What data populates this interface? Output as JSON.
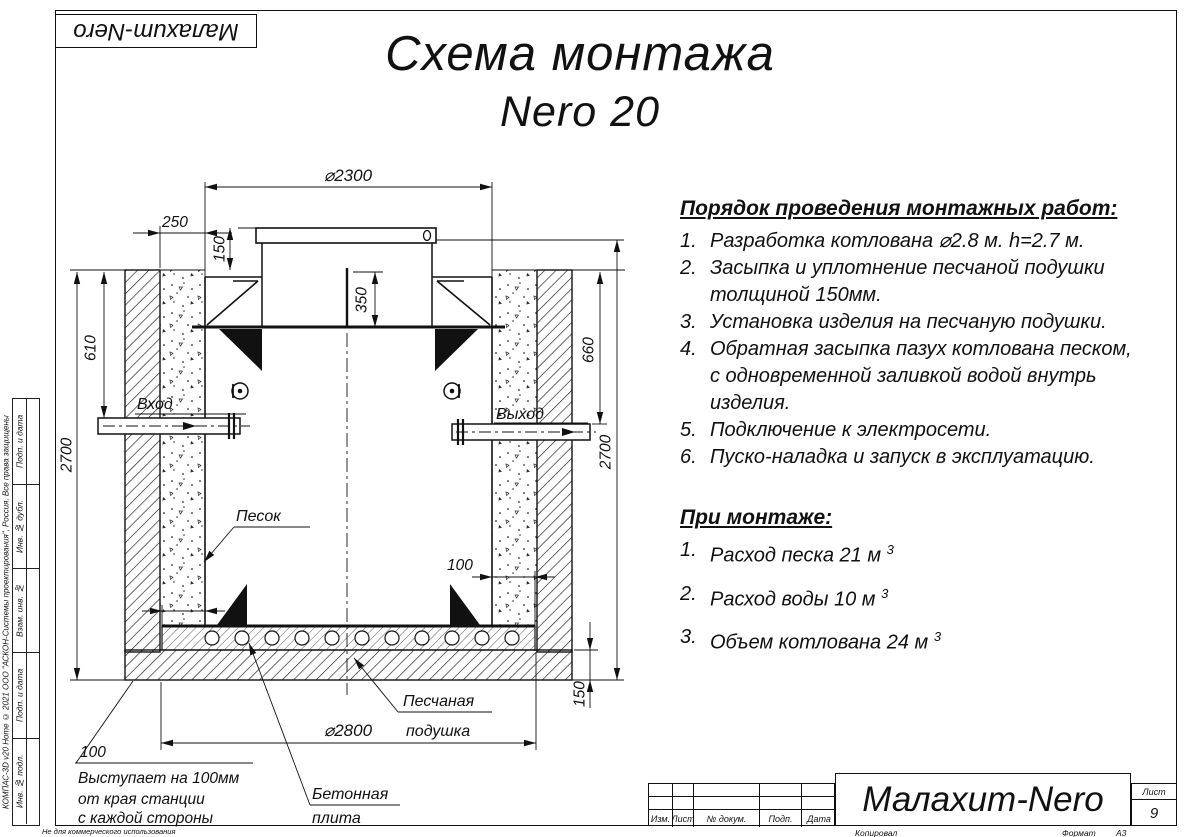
{
  "page": {
    "stamp_top": "Малахит-Nero",
    "title": "Схема монтажа",
    "subtitle": "Nero 20",
    "bottom_note": "Не для коммерческого использования",
    "copyright_vertical": "КОМПАС-3D v20 Home © 2021 ООО \"АСКОН-Системы проектирования\", Россия. Все права защищены"
  },
  "left_stamp": {
    "cells": [
      "Подп. и дата",
      "Инв. № дубл.",
      "Взам. инв. №",
      "Подп. и дата",
      "Инв. № подл."
    ]
  },
  "instructions": {
    "heading": "Порядок проведения монтажных работ:",
    "items": [
      {
        "num": "1.",
        "text": "Разработка котлована ⌀2.8 м. h=2.7 м."
      },
      {
        "num": "2.",
        "text": "Засыпка и уплотнение песчаной подушки\nтолщиной 150мм."
      },
      {
        "num": "3.",
        "text": "Установка изделия на песчаную подушки."
      },
      {
        "num": "4.",
        "text": "Обратная засыпка пазух котлована песком,\nс одновременной заливкой водой внутрь\nизделия."
      },
      {
        "num": "5.",
        "text": "Подключение к электросети."
      },
      {
        "num": "6.",
        "text": "Пуско-наладка и запуск в эксплуатацию."
      }
    ]
  },
  "montage": {
    "heading": "При монтаже:",
    "items": [
      {
        "num": "1.",
        "text": "Расход песка 21 м",
        "sup": "3"
      },
      {
        "num": "2.",
        "text": "Расход воды 10 м",
        "sup": "3"
      },
      {
        "num": "3.",
        "text": "Объем котлована 24 м",
        "sup": "3"
      }
    ]
  },
  "drawing": {
    "dims": {
      "d2300": "⌀2300",
      "d2800": "⌀2800",
      "gap250": "250",
      "lid150": "150",
      "neck350": "350",
      "inlet610": "610",
      "outlet660": "660",
      "left2700": "2700",
      "right2700": "2700",
      "plate100_right": "100",
      "cushion150": "150"
    },
    "labels": {
      "inlet": "Вход",
      "outlet": "Выход",
      "sand": "Песок",
      "cushion_line1": "Песчаная",
      "cushion_line2": "подушка",
      "plate_line1": "Бетонная",
      "plate_line2": "плита",
      "overhang_value": "100",
      "overhang_line1": "Выступает на 100мм",
      "overhang_line2": "от края станции",
      "overhang_line3": "с каждой стороны"
    }
  },
  "titleblock": {
    "headers": [
      "Изм.",
      "Лист",
      "№ докум.",
      "Подп.",
      "Дата"
    ],
    "name": "Малахит-Nero",
    "sheet_label": "Лист",
    "sheet_number": "9",
    "copied_label": "Копировал",
    "format_label": "Формат",
    "format_value": "A3"
  }
}
